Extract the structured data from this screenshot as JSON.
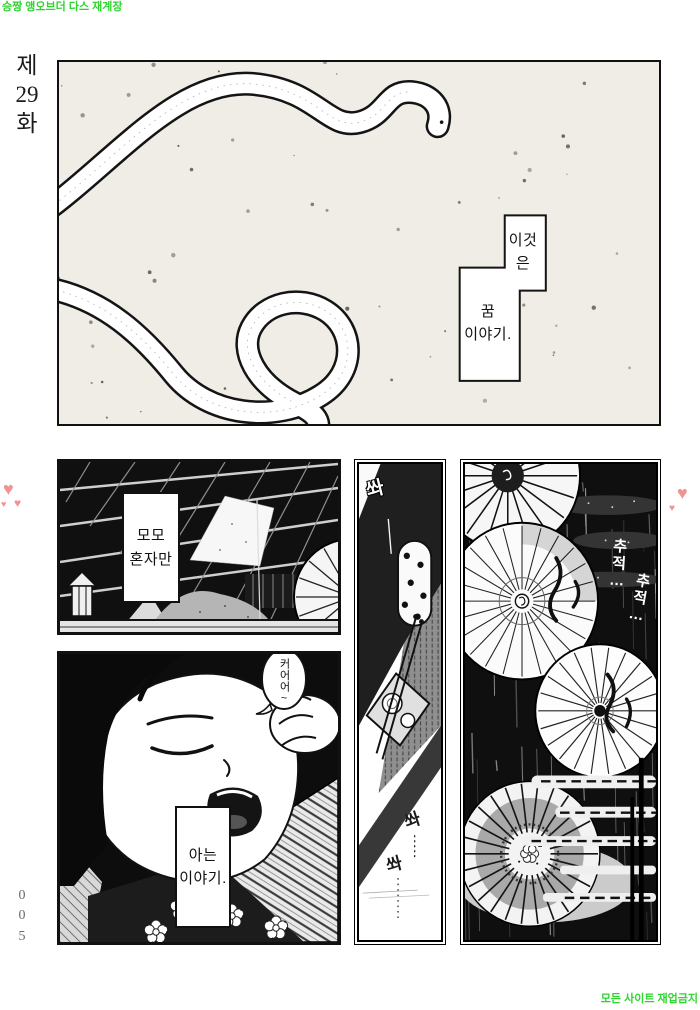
{
  "watermarks": {
    "top_left": "승짱 앵오브더 다스 재계장",
    "bottom_right": "모든 사이트 재업금지"
  },
  "episode": {
    "label": "제\n29\n화"
  },
  "page_number": {
    "label": "0\n0\n5"
  },
  "icons": {
    "heart": "♥"
  },
  "dream_panel": {
    "box_top": "이것\n은",
    "box_bottom": "꿈\n이야기."
  },
  "attic_panel": {
    "caption": "모모\n혼자만"
  },
  "sleep_panel": {
    "bubble": "커어어~",
    "caption": "아는\n이야기."
  },
  "hall_panel": {
    "sfx_top": "쏴",
    "sfx_mid": "쏴",
    "sfx_bottom": "쏴"
  },
  "rain_panel": {
    "sfx_1": "추적…",
    "sfx_2": "추적…"
  },
  "colors": {
    "watermark_green": "#2ed52e",
    "heart_pink": "#f09392",
    "ink": "#111111",
    "paper_speckle_bg": "#f0ede7"
  }
}
